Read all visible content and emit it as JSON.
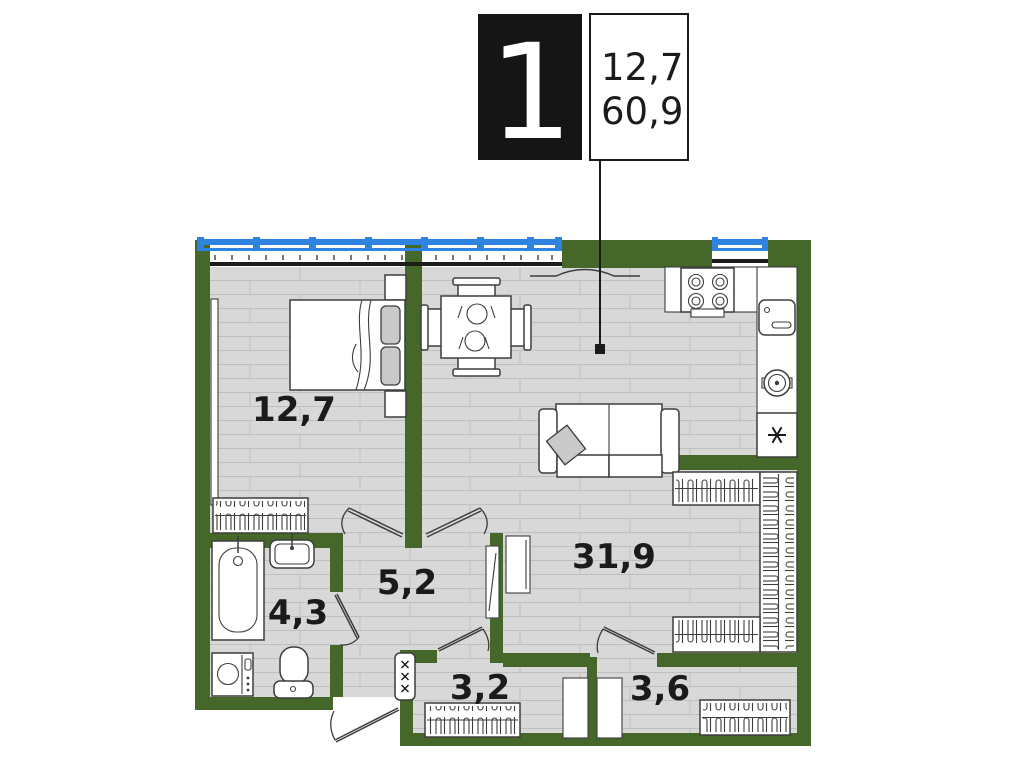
{
  "title_block": {
    "plan_number": "1",
    "room_area": "12,7",
    "total_area": "60,9"
  },
  "rooms": {
    "bedroom": {
      "label": "12,7"
    },
    "living_kitchen": {
      "label": "31,9"
    },
    "hallway": {
      "label": "5,2"
    },
    "bathroom": {
      "label": "4,3"
    },
    "storage_left": {
      "label": "3,2"
    },
    "storage_right": {
      "label": "3,6"
    }
  },
  "icons": {
    "fridge_mark": "asterisk-snowflake",
    "shaft_mark": "triple-x",
    "furniture": [
      "bed",
      "wardrobe",
      "dining-table",
      "sofa",
      "stove",
      "kitchen-sink",
      "boiler",
      "fridge",
      "bathtub",
      "washbasin",
      "washing-machine",
      "toilet",
      "mirror",
      "hanger-rail"
    ]
  },
  "colors": {
    "page": "#ffffff",
    "wall": "#45682a",
    "window_blue": "#2e82e0",
    "floor": "#d8d8d8",
    "floor_line": "#bfbfbf",
    "outline": "#3d3d3d",
    "ink": "#1b1b1b",
    "pillow": "#c9c9c9"
  }
}
